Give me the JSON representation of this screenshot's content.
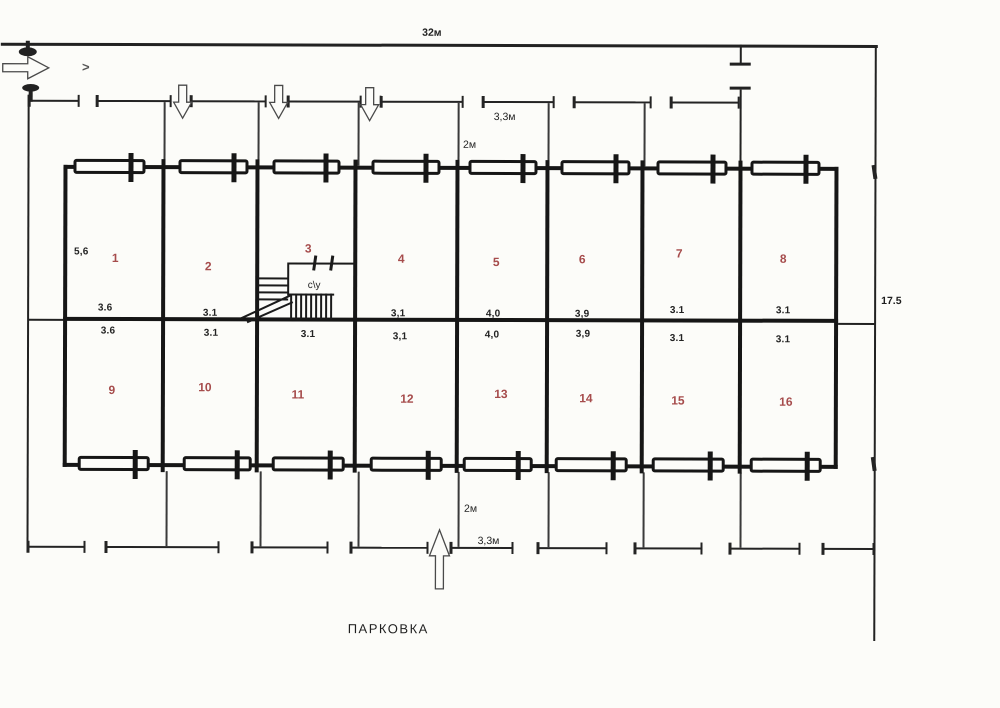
{
  "labels": {
    "top_width": "32м",
    "right_height": "17.5",
    "bay_width_top": "3,3м",
    "walk_depth_top": "2м",
    "bay_width_bottom": "3,3м",
    "walk_depth_bottom": "2м",
    "parking": "ПАРКОВКА",
    "utility_room": "c\\y",
    "direction_mark": ">"
  },
  "room_numbers": [
    "1",
    "2",
    "3",
    "4",
    "5",
    "6",
    "7",
    "8",
    "9",
    "10",
    "11",
    "12",
    "13",
    "14",
    "15",
    "16"
  ],
  "dims_upper": [
    "5,6",
    "3.6",
    "3.1",
    "3,1",
    "4,0",
    "3,9",
    "3.1",
    "3.1"
  ],
  "dims_lower": [
    "3.6",
    "3.1",
    "3.1",
    "3,1",
    "4,0",
    "3,9",
    "3.1",
    "3.1"
  ],
  "colors": {
    "ink": "#222222",
    "walls": "#161616",
    "room_number_red": "#a64c4c",
    "paper": "#fcfcf9"
  }
}
